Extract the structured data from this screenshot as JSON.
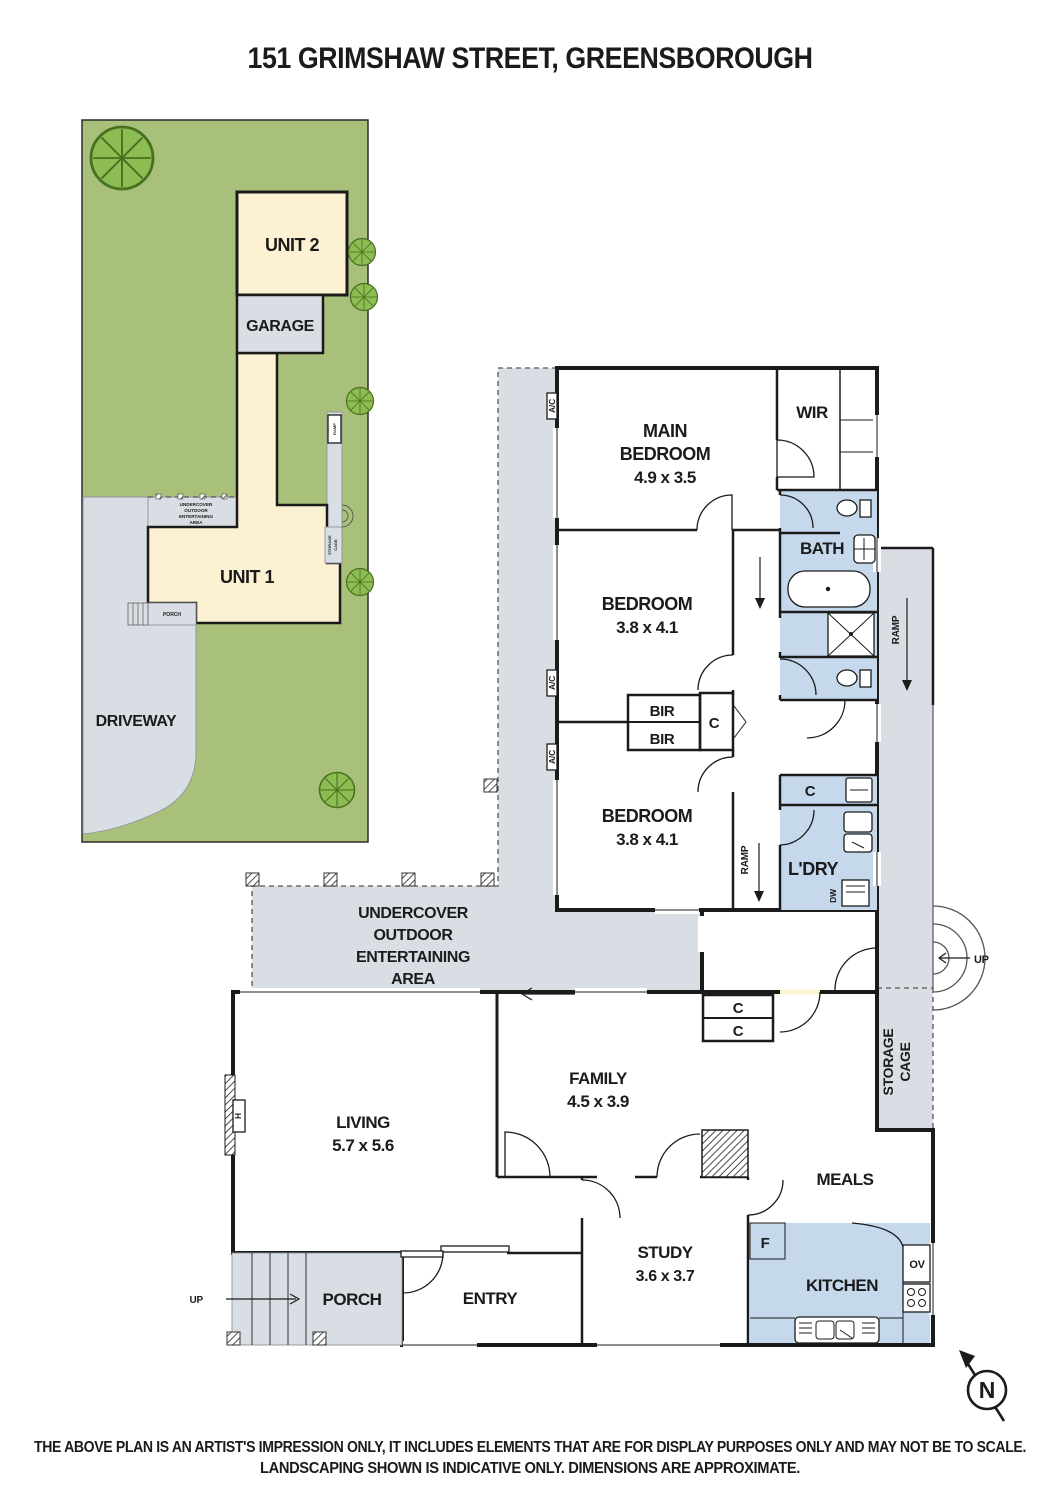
{
  "title": "151 GRIMSHAW STREET, GREENSBOROUGH",
  "colors": {
    "grass": "#a9c07b",
    "tree": "#8dbc52",
    "tree_outline": "#47701f",
    "room_cream": "#fcf1d2",
    "wet_blue": "#c6d9ec",
    "paved_gray": "#d9dee4",
    "wall_dark": "#1b1b1b"
  },
  "site_plan": {
    "unit2_label": "UNIT 2",
    "garage_label": "GARAGE",
    "unit1_label": "UNIT 1",
    "driveway_label": "DRIVEWAY",
    "porch_label": "PORCH",
    "ramp_label": "RAMP",
    "storage_cage_line1": "STORAGE",
    "storage_cage_line2": "CAGE",
    "uoea_lines": [
      "UNDERCOVER",
      "OUTDOOR",
      "ENTERTAINING",
      "AREA"
    ]
  },
  "floor_plan": {
    "main_bedroom": {
      "name_line1": "MAIN",
      "name_line2": "BEDROOM",
      "dims": "4.9 x 3.5"
    },
    "bedroom2": {
      "name": "BEDROOM",
      "dims": "3.8 x 4.1"
    },
    "bedroom3": {
      "name": "BEDROOM",
      "dims": "3.8 x 4.1"
    },
    "living": {
      "name": "LIVING",
      "dims": "5.7 x 5.6"
    },
    "family": {
      "name": "FAMILY",
      "dims": "4.5 x 3.9"
    },
    "study": {
      "name": "STUDY",
      "dims": "3.6 x 3.7"
    },
    "wir_label": "WIR",
    "bath_label": "BATH",
    "laundry_label": "L'DRY",
    "kitchen_label": "KITCHEN",
    "meals_label": "MEALS",
    "entry_label": "ENTRY",
    "porch_label": "PORCH",
    "bir_label": "BIR",
    "closet_label": "C",
    "ac_label": "A/C",
    "ramp_label": "RAMP",
    "up_label": "UP",
    "dw_label": "DW",
    "fridge_label": "F",
    "oven_label": "OV",
    "heater_label": "H",
    "storage_cage_line1": "STORAGE",
    "storage_cage_line2": "CAGE",
    "uoea_lines": [
      "UNDERCOVER",
      "OUTDOOR",
      "ENTERTAINING",
      "AREA"
    ]
  },
  "north_label": "N",
  "disclaimer_lines": [
    "THE ABOVE PLAN IS AN ARTIST'S IMPRESSION ONLY, IT INCLUDES ELEMENTS THAT ARE FOR DISPLAY PURPOSES ONLY AND MAY NOT BE TO SCALE.",
    "LANDSCAPING SHOWN IS INDICATIVE ONLY. DIMENSIONS ARE APPROXIMATE."
  ]
}
